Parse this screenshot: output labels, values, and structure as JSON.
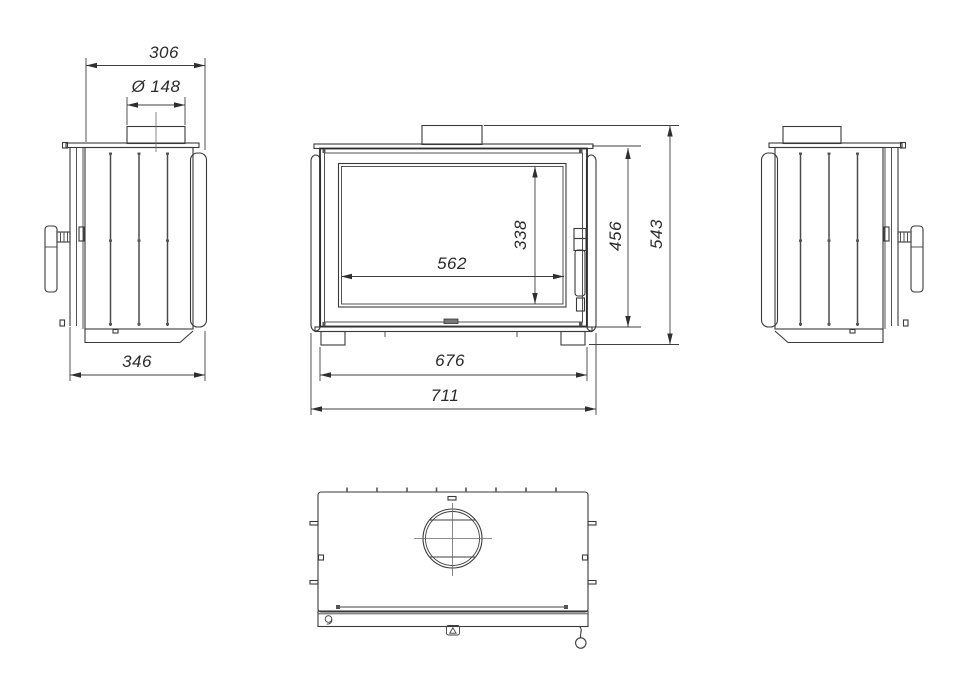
{
  "dimensions": {
    "body_depth": "306",
    "flue_diameter": "Ø 148",
    "overall_depth": "346",
    "glass_width": "562",
    "glass_height": "338",
    "body_height": "456",
    "overall_height": "543",
    "body_width": "676",
    "overall_width": "711"
  }
}
